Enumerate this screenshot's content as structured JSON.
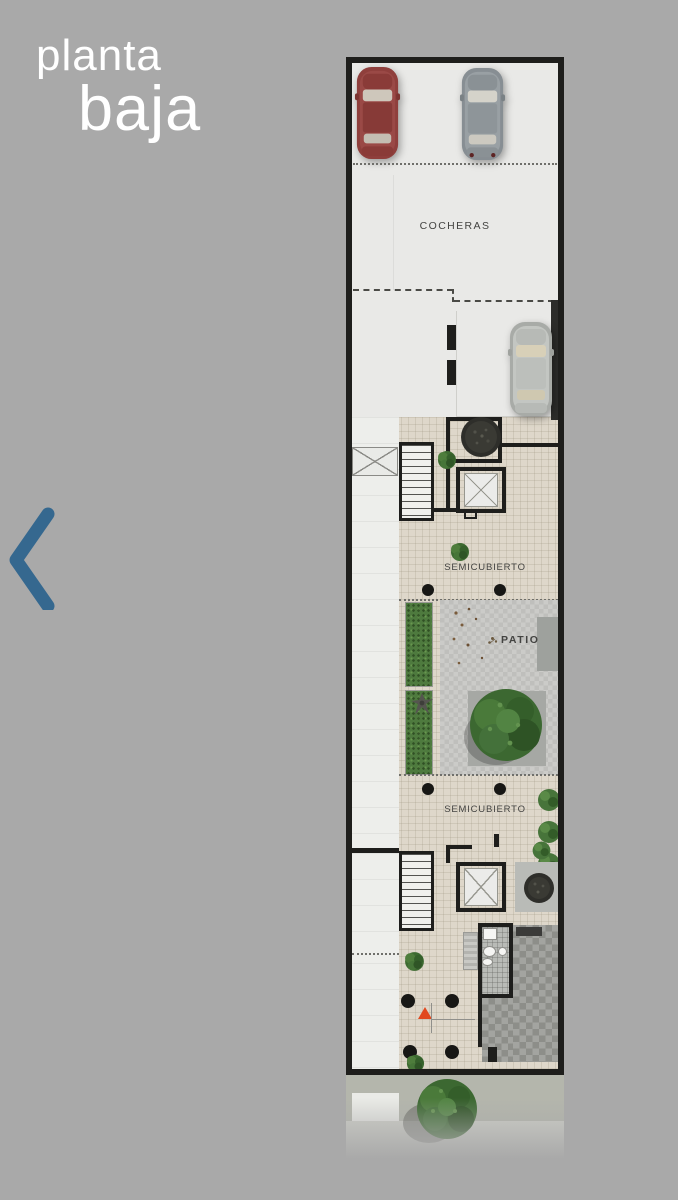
{
  "title": {
    "line1": "planta",
    "line2": "baja"
  },
  "nav": {
    "back": {
      "icon": "chevron-left",
      "label": "previous plan"
    }
  },
  "colors": {
    "bg": "#a9a9a9",
    "accent-blue": "#35688f",
    "wall": "#1e1e1c",
    "garage-floor": "#e9e9e7",
    "tile-floor": "#ded7ca",
    "white-floor": "#edeeeb",
    "checker-a": "#cbcbc8",
    "checker-b": "#bfbfbc",
    "stone": "#a3a4a0",
    "hedge": "#4e7a3e",
    "tree": "#3f6b33",
    "street": "#b4b6ac",
    "sidewalk": "#d0d1ca",
    "triangle": "#e1491f",
    "label": "#434341",
    "title-text": "#ffffff"
  },
  "floorplan": {
    "labels": {
      "cocheras": "COCHERAS",
      "semicubierto_upper": "SEMICUBIERTO",
      "patio": "PATIO",
      "semicubierto_lower": "SEMICUBIERTO"
    }
  }
}
